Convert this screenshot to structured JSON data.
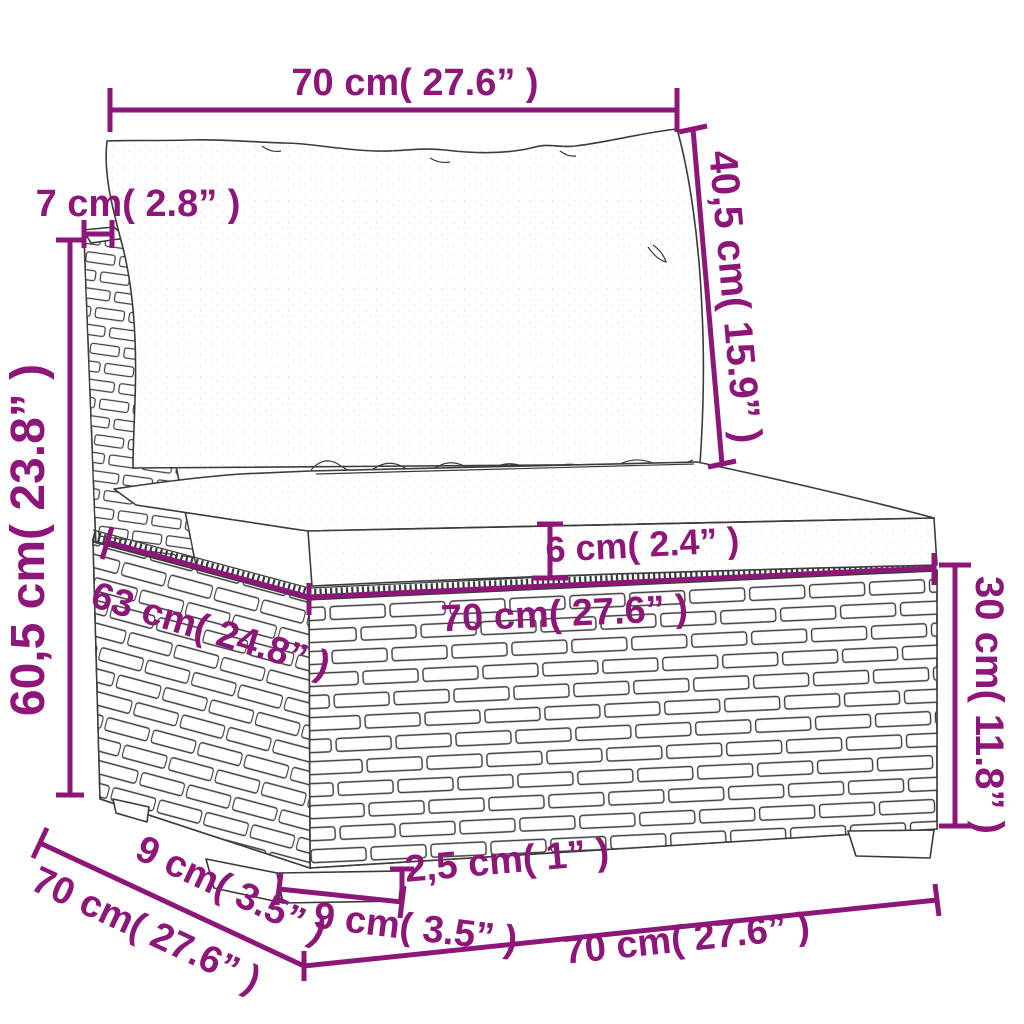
{
  "diagram": {
    "kind": "product-dimension-diagram",
    "subject": "poly rattan garden sofa middle section with back cushion and seat cushion",
    "accent_color": "#8D1778",
    "sketch_color": "#3a3a3a",
    "unit_system": "cm (inches)",
    "dimensions": [
      {
        "id": "back-cushion-width",
        "label": "70 cm( 27.6” )"
      },
      {
        "id": "back-panel-thickness",
        "label": "7 cm( 2.8” )"
      },
      {
        "id": "back-cushion-height",
        "label": "40,5 cm( 15.9” )"
      },
      {
        "id": "overall-height",
        "label": "60,5 cm( 23.8” )"
      },
      {
        "id": "seat-cushion-thickness",
        "label": "6 cm( 2.4” )"
      },
      {
        "id": "seat-depth",
        "label": "63 cm( 24.8” )"
      },
      {
        "id": "seat-width",
        "label": "70 cm( 27.6” )"
      },
      {
        "id": "base-height",
        "label": "30 cm( 11.8” )"
      },
      {
        "id": "foot-depth",
        "label": "9 cm( 3.5” )"
      },
      {
        "id": "overall-depth",
        "label": "70 cm( 27.6” )"
      },
      {
        "id": "foot-height",
        "label": "2,5 cm( 1” )"
      },
      {
        "id": "foot-width",
        "label": "9 cm( 3.5” )"
      },
      {
        "id": "overall-width",
        "label": "70 cm( 27.6” )"
      }
    ]
  }
}
